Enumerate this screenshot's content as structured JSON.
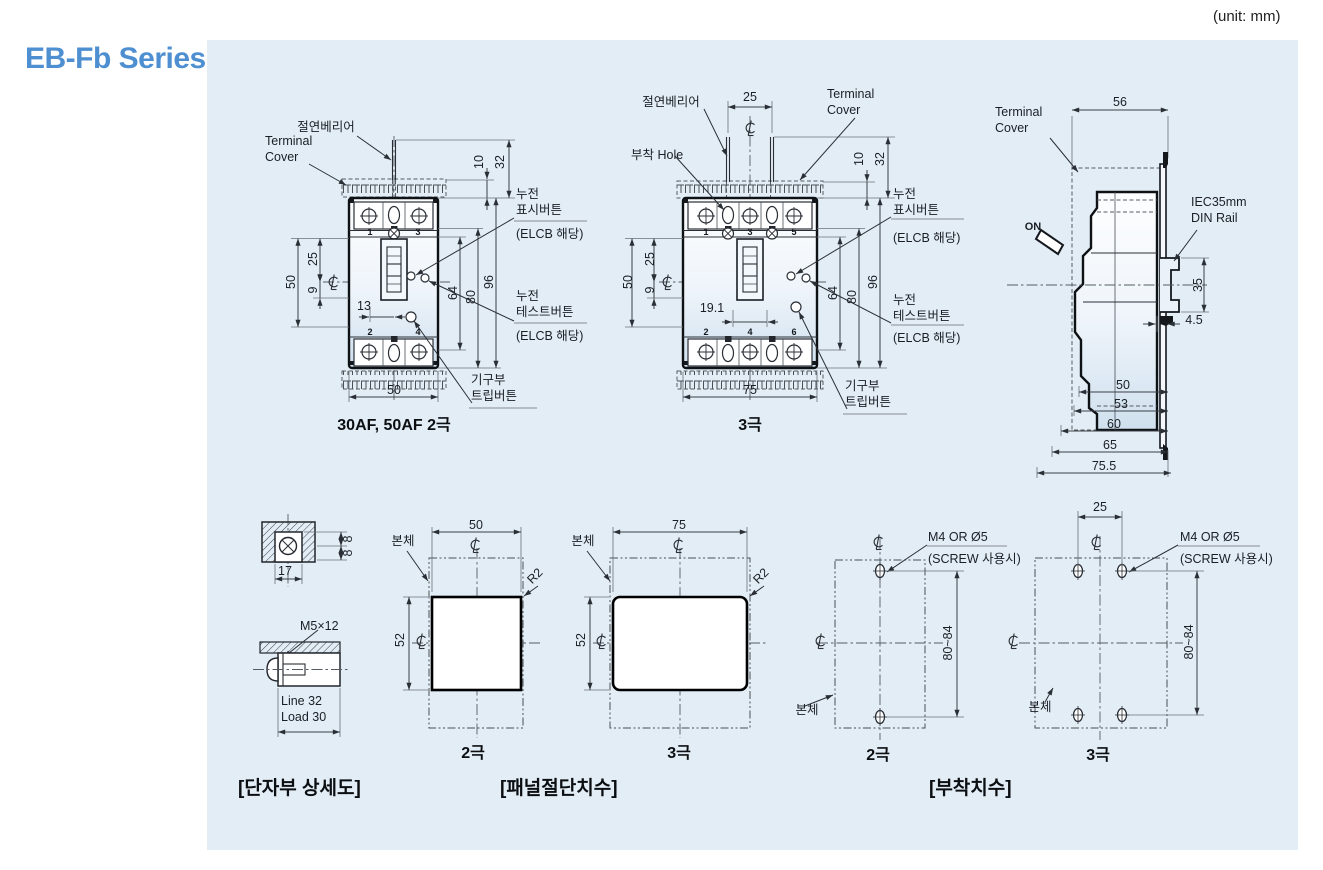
{
  "page": {
    "title": "EB-Fb Series",
    "unit": "(unit: mm)"
  },
  "symbols": {
    "centerline": "℄"
  },
  "front_2pole": {
    "caption": "30AF, 50AF 2극",
    "labels": {
      "insulation_barrier": "절연베리어",
      "terminal_cover": "Terminal\nCover",
      "leakage_indicator_button": "누전\n표시버튼",
      "leakage_indicator_note": "(ELCB 해당)",
      "leakage_test_button": "누전\n테스트버튼",
      "leakage_test_note": "(ELCB 해당)",
      "trip_button": "기구부\n트립버튼"
    },
    "dims": {
      "cover_height": "10",
      "barrier_height": "32",
      "left_height": "50",
      "upper_offset": "25",
      "lower_offset": "9",
      "handle_offset": "13",
      "inner_height": "64",
      "cover_span": "80",
      "total_height": "96",
      "width": "50"
    },
    "pole_numbers_top": [
      "1",
      "3"
    ],
    "pole_numbers_bottom": [
      "2",
      "4"
    ]
  },
  "front_3pole": {
    "caption": "3극",
    "labels": {
      "insulation_barrier": "절연베리어",
      "mounting_hole": "부착 Hole",
      "terminal_cover": "Terminal\nCover",
      "leakage_indicator_button": "누전\n표시버튼",
      "leakage_indicator_note": "(ELCB 해당)",
      "leakage_test_button": "누전\n테스트버튼",
      "leakage_test_note": "(ELCB 해당)",
      "trip_button": "기구부\n트립버튼"
    },
    "dims": {
      "barrier_pitch": "25",
      "cover_height": "10",
      "barrier_height": "32",
      "left_height": "50",
      "upper_offset": "25",
      "lower_offset": "9",
      "center_offset": "19.1",
      "inner_height": "64",
      "cover_span": "80",
      "total_height": "96",
      "width": "75"
    },
    "pole_numbers_top": [
      "1",
      "3",
      "5"
    ],
    "pole_numbers_bottom": [
      "2",
      "4",
      "6"
    ]
  },
  "side_view": {
    "labels": {
      "terminal_cover": "Terminal\nCover",
      "on": "ON",
      "din_rail": "IEC35mm\nDIN Rail"
    },
    "dims": {
      "cover_depth": "56",
      "din_rail_height": "35",
      "plate_offset": "4.5",
      "depth_1": "50",
      "depth_2": "53",
      "depth_3": "60",
      "depth_4": "65",
      "depth_total": "75.5"
    }
  },
  "terminal_detail": {
    "caption": "[단자부 상세도]",
    "labels": {
      "screw_spec": "M5×12",
      "wire_capacity": "Line 32\nLoad 30"
    },
    "dims": {
      "upper": "8",
      "lower": "8",
      "width": "17"
    }
  },
  "panel_cutout": {
    "caption": "[패널절단치수]",
    "two_pole": {
      "caption": "2극",
      "body": "본체",
      "radius": "R2",
      "dims": {
        "width": "50",
        "height": "52"
      }
    },
    "three_pole": {
      "caption": "3극",
      "body": "본체",
      "radius": "R2",
      "dims": {
        "width": "75",
        "height": "52"
      }
    }
  },
  "mounting": {
    "caption": "[부착치수]",
    "two_pole": {
      "caption": "2극",
      "body": "본체",
      "screw": "M4 OR Ø5",
      "screw_note": "(SCREW 사용시)",
      "dims": {
        "vertical": "80~84"
      }
    },
    "three_pole": {
      "caption": "3극",
      "body": "본체",
      "screw": "M4 OR Ø5",
      "screw_note": "(SCREW 사용시)",
      "dims": {
        "horizontal": "25",
        "vertical": "80~84"
      }
    }
  }
}
